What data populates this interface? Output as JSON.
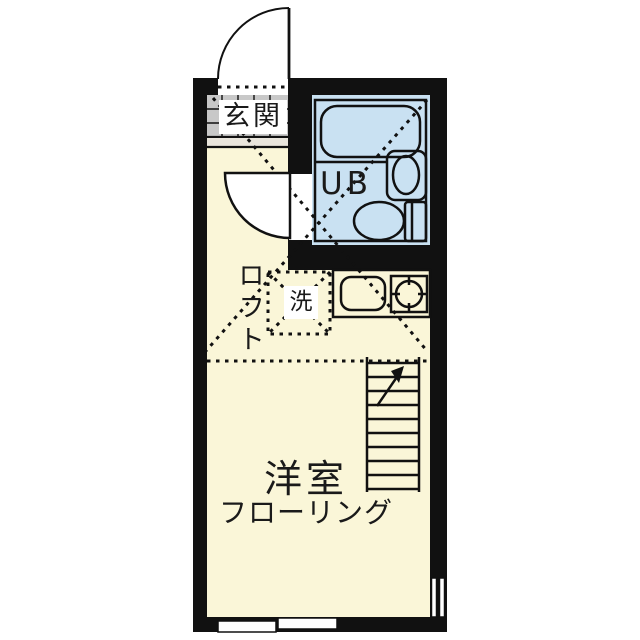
{
  "plan": {
    "type": "apartment-floor-plan",
    "labels": {
      "entrance": "玄関",
      "unit_bath": "UB",
      "loft": "ロフト",
      "laundry": "洗",
      "room": "洋室",
      "flooring": "フローリング"
    },
    "colors": {
      "wall": "#111111",
      "background": "#ffffff",
      "room_fill": "#faf6d8",
      "wet_fill": "#c9e1f2",
      "tile_fill": "#c8c8c8",
      "step_fill": "#e9e5dc",
      "label_bg": "#ffffff",
      "line": "#111111"
    },
    "fixtures": [
      "entrance-door",
      "bathroom-door",
      "bathtub",
      "vanity-sink",
      "toilet",
      "kitchen-sink",
      "stove-burner",
      "laundry-space",
      "loft-ladder",
      "sliding-window-bottom",
      "sliding-window-right",
      "loft-dashed-area"
    ]
  }
}
